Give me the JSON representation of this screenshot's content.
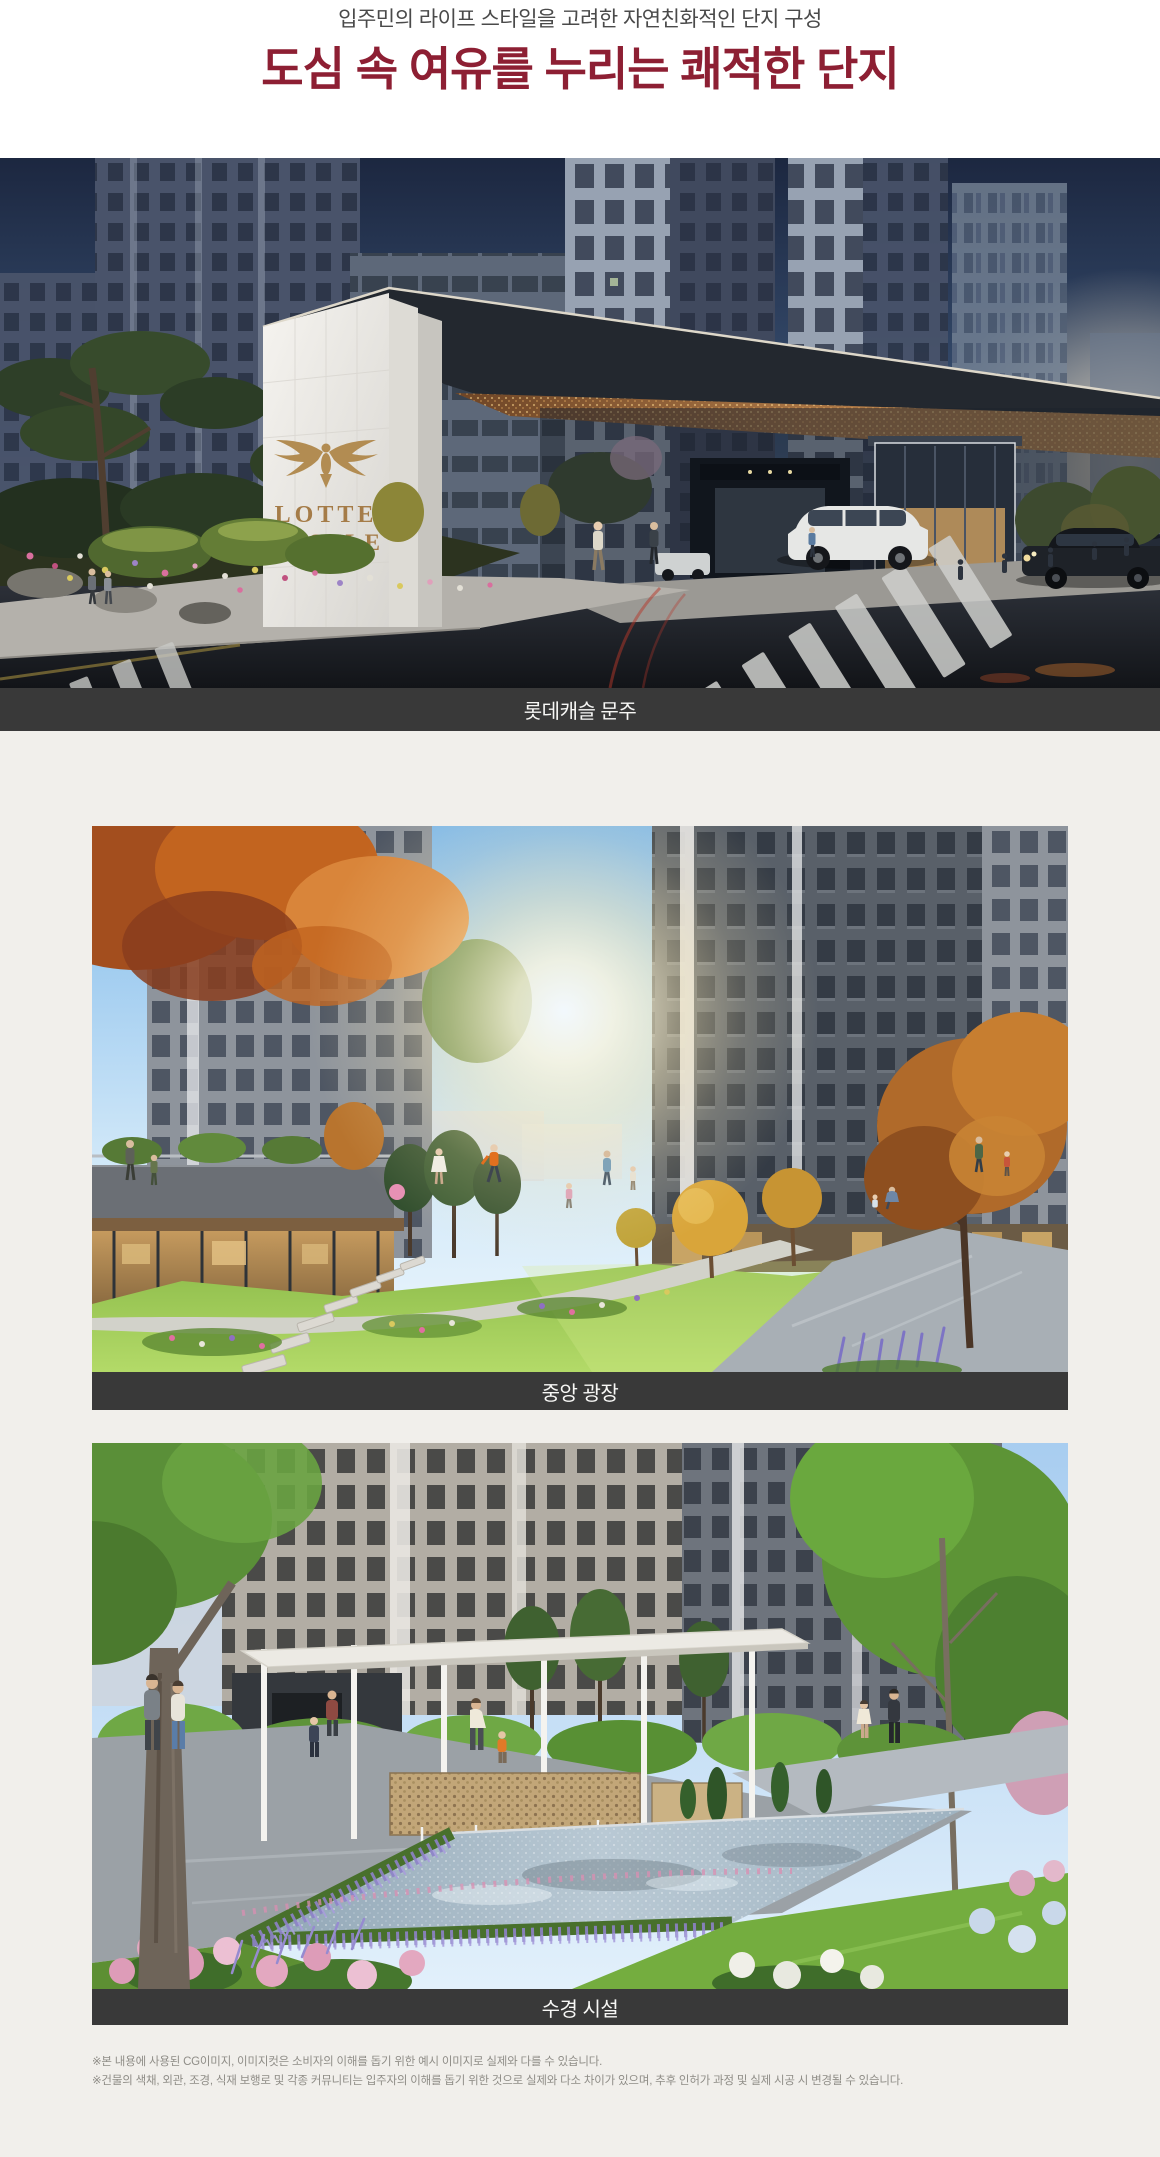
{
  "header": {
    "subtitle": "입주민의 라이프 스타일을 고려한 자연친화적인 단지 구성",
    "title": "도심 속 여유를 누리는 쾌적한 단지"
  },
  "colors": {
    "title_accent": "#8d1f33",
    "subtitle_gray": "#4a4a4a",
    "caption_bar_bg": "#393939",
    "caption_text": "#f7f7f5",
    "page_background": "#f1efeb",
    "header_background": "#ffffff"
  },
  "figures": [
    {
      "caption": "롯데캐슬 문주",
      "scene": "dusk entrance gate rendering",
      "logo": {
        "line1": "LOTTE",
        "line2": "CASTLE"
      }
    },
    {
      "caption": "중앙 광장",
      "scene": "daytime central plaza lawn rendering"
    },
    {
      "caption": "수경 시설",
      "scene": "daytime water feature courtyard rendering"
    }
  ],
  "disclaimers": {
    "line1": "※본 내용에 사용된 CG이미지, 이미지컷은 소비자의 이해를 돕기 위한 예시 이미지로 실제와 다를 수 있습니다.",
    "line2": "※건물의 색채, 외관, 조경, 식재 보행로 및 각종 커뮤니티는 입주자의 이해를 돕기 위한 것으로 실제와 다소 차이가 있으며, 추후 인허가 과정 및 실제 시공 시 변경될 수 있습니다."
  }
}
